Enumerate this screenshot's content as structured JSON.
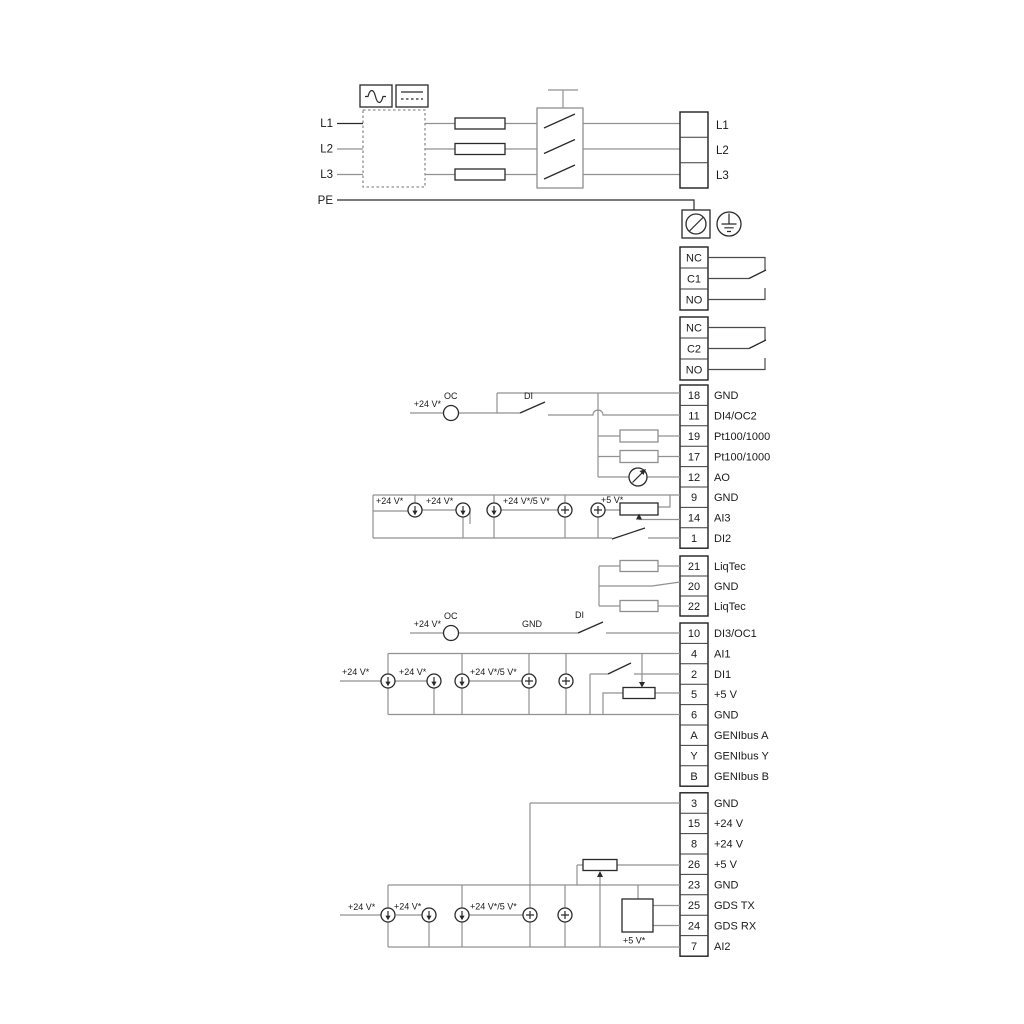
{
  "power": {
    "inputs": [
      {
        "label": "L1"
      },
      {
        "label": "L2"
      },
      {
        "label": "L3"
      }
    ],
    "pe_label": "PE",
    "outputs": [
      {
        "label": "L1"
      },
      {
        "label": "L2"
      },
      {
        "label": "L3"
      }
    ]
  },
  "relay1": {
    "rows": [
      {
        "label": "NC"
      },
      {
        "label": "C1"
      },
      {
        "label": "NO"
      }
    ]
  },
  "relay2": {
    "rows": [
      {
        "label": "NC"
      },
      {
        "label": "C2"
      },
      {
        "label": "NO"
      }
    ]
  },
  "strip_io1": {
    "rows": [
      {
        "num": "18",
        "label": "GND"
      },
      {
        "num": "11",
        "label": "DI4/OC2"
      },
      {
        "num": "19",
        "label": "Pt100/1000"
      },
      {
        "num": "17",
        "label": "Pt100/1000"
      },
      {
        "num": "12",
        "label": "AO"
      },
      {
        "num": "9",
        "label": "GND"
      },
      {
        "num": "14",
        "label": "AI3"
      },
      {
        "num": "1",
        "label": "DI2"
      }
    ]
  },
  "strip_liqtec": {
    "rows": [
      {
        "num": "21",
        "label": "LiqTec"
      },
      {
        "num": "20",
        "label": "GND"
      },
      {
        "num": "22",
        "label": "LiqTec"
      }
    ]
  },
  "strip_io2": {
    "rows": [
      {
        "num": "10",
        "label": "DI3/OC1"
      },
      {
        "num": "4",
        "label": "AI1"
      },
      {
        "num": "2",
        "label": "DI1"
      },
      {
        "num": "5",
        "label": "+5 V"
      },
      {
        "num": "6",
        "label": "GND"
      },
      {
        "num": "A",
        "label": "GENIbus A"
      },
      {
        "num": "Y",
        "label": "GENIbus Y"
      },
      {
        "num": "B",
        "label": "GENIbus B"
      }
    ]
  },
  "strip_io3": {
    "rows": [
      {
        "num": "3",
        "label": "GND"
      },
      {
        "num": "15",
        "label": "+24 V"
      },
      {
        "num": "8",
        "label": "+24 V"
      },
      {
        "num": "26",
        "label": "+5 V"
      },
      {
        "num": "23",
        "label": "GND"
      },
      {
        "num": "25",
        "label": "GDS TX"
      },
      {
        "num": "24",
        "label": "GDS RX"
      },
      {
        "num": "7",
        "label": "AI2"
      }
    ]
  },
  "wire_labels": {
    "v24": "+24 V*",
    "v24_5": "+24 V*/5 V*",
    "v5": "+5 V*",
    "oc": "OC",
    "di": "DI",
    "gnd": "GND"
  }
}
